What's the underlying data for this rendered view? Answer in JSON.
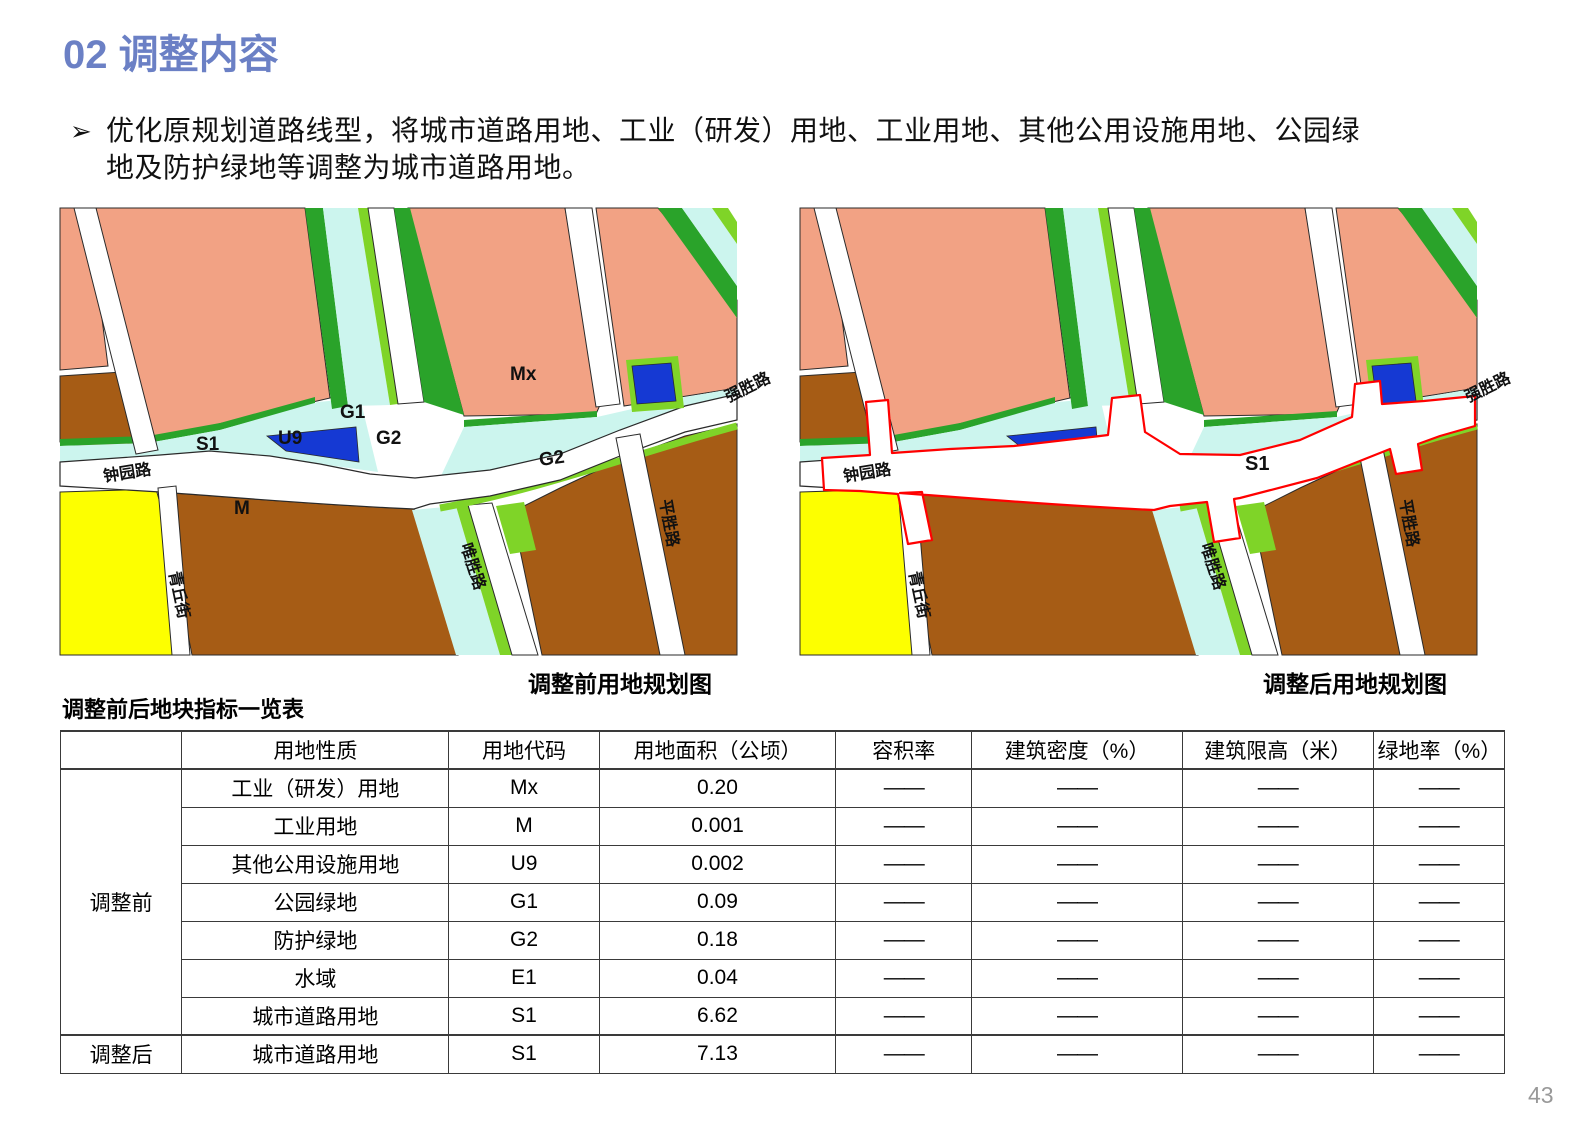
{
  "page": {
    "title": "02 调整内容",
    "page_number": "43"
  },
  "bullet": {
    "marker": "➢",
    "line1": "优化原规划道路线型，将城市道路用地、工业（研发）用地、工业用地、其他公用设施用地、公园绿",
    "line2": "地及防护绿地等调整为城市道路用地。"
  },
  "maps": {
    "before": {
      "caption": "调整前用地规划图",
      "zone_labels": {
        "mx": "Mx",
        "m": "M",
        "u9": "U9",
        "g1": "G1",
        "g2_west": "G2",
        "g2_east": "G2",
        "s1": "S1"
      },
      "roads": {
        "zhongyuanlu": "钟园路",
        "qingqiujie": "青丘街",
        "weishenglu": "唯胜路",
        "pingshenglu": "平胜路",
        "qiangshenglu": "强胜路"
      }
    },
    "after": {
      "caption": "调整后用地规划图",
      "zone_labels": {
        "s1": "S1"
      },
      "roads": {
        "zhongyuanlu": "钟园路",
        "qingqiujie": "青丘街",
        "weishenglu": "唯胜路",
        "pingshenglu": "平胜路",
        "qiangshenglu": "强胜路"
      },
      "highlight_color": "#FF0000"
    }
  },
  "table": {
    "title": "调整前后地块指标一览表",
    "dash": "——",
    "headers": [
      "",
      "用地性质",
      "用地代码",
      "用地面积（公顷）",
      "容积率",
      "建筑密度（%）",
      "建筑限高（米）",
      "绿地率（%）"
    ],
    "groups": [
      {
        "label": "调整前",
        "rows": [
          [
            "工业（研发）用地",
            "Mx",
            "0.20"
          ],
          [
            "工业用地",
            "M",
            "0.001"
          ],
          [
            "其他公用设施用地",
            "U9",
            "0.002"
          ],
          [
            "公园绿地",
            "G1",
            "0.09"
          ],
          [
            "防护绿地",
            "G2",
            "0.18"
          ],
          [
            "水域",
            "E1",
            "0.04"
          ],
          [
            "城市道路用地",
            "S1",
            "6.62"
          ]
        ]
      },
      {
        "label": "调整后",
        "rows": [
          [
            "城市道路用地",
            "S1",
            "7.13"
          ]
        ]
      }
    ]
  },
  "colors": {
    "title-blue": "#6B80C5",
    "salmon": "#F2A284",
    "brown": "#A65C15",
    "dkgreen": "#2AA32A",
    "lime": "#7FD428",
    "cyan": "#CCF5EE",
    "blue": "#1539D3",
    "yellow": "#FDFF00",
    "red": "#FF0000",
    "road-outline": "#2a2a2a",
    "page-num": "#999999"
  }
}
